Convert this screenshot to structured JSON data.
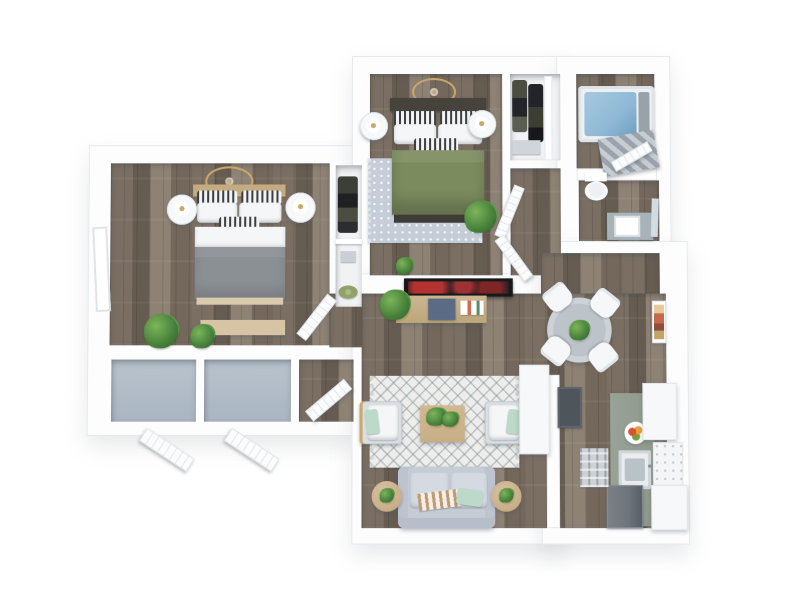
{
  "meta": {
    "title": "3D rendered floor plan — two bedroom apartment",
    "view": "top-down 3D render",
    "visible_text": "none"
  },
  "palette": {
    "background": "#ffffff",
    "wall": "#fdfdfd",
    "wall_edge": "#e7eaee",
    "wood": "#7b6f63",
    "wood_dark": "#675c51",
    "wood_light": "#8e8274",
    "closet_floor": "#a9b5c1",
    "rug_living": "#edeeec",
    "rug_bedroom": "#c5ced8",
    "bed_gray": "#8b9095",
    "bed_green": "#7c8b5e",
    "headboard_dark": "#46423c",
    "headboard_tan": "#c4ab80",
    "pillow_white": "#f4f6f7",
    "mint": "#bcd9c9",
    "tub_water": "#8fb9d6",
    "curtain_gray": "#9aa3ab",
    "counter_sage": "#8e988c",
    "cabinet_white": "#f7f8f9",
    "fridge_gray": "#6d747b",
    "stove_gray": "#4e555b",
    "tv_black": "#17181a",
    "tv_red": "#b43434",
    "table_gray": "#bcc3c9",
    "side_table_tan": "#c8ae87",
    "plant_green": "#46803a",
    "plant_dark": "#2f5e28",
    "gold": "#c9a96a",
    "bench_tan": "#d7c4a4",
    "blue_box": "#5a6b86",
    "art_accent": "#c46a4a"
  },
  "scene": {
    "rooms": [
      {
        "name": "bedroom-1",
        "position": "left",
        "items": [
          "ceiling-fan-gold",
          "bed-gray-queen",
          "nightstand-left",
          "nightstand-right",
          "table-lamps",
          "foot-bench",
          "potted-plants",
          "window",
          "reach-in-closet"
        ]
      },
      {
        "name": "bedroom-2",
        "position": "top-center",
        "items": [
          "ceiling-medallion-gold",
          "bed-green-queen",
          "nightstand-left",
          "nightstand-right",
          "patterned-area-rug",
          "potted-plant",
          "walk-in-closet-with-clothes"
        ]
      },
      {
        "name": "bathroom",
        "position": "top-right",
        "items": [
          "bathtub-with-water",
          "shower-curtain",
          "toilet",
          "vanity-with-sink",
          "mirror"
        ]
      },
      {
        "name": "hallway-vestibule",
        "position": "center",
        "items": [
          "open-door",
          "open-door"
        ]
      },
      {
        "name": "dining-area",
        "position": "right-center",
        "items": [
          "round-table",
          "dining-chair-1",
          "dining-chair-2",
          "dining-chair-3",
          "dining-chair-4",
          "centerpiece-plant",
          "wall-art"
        ]
      },
      {
        "name": "living-room",
        "position": "bottom-center",
        "items": [
          "tv",
          "media-console",
          "monstera-plant",
          "storage-box",
          "books",
          "diamond-pattern-rug",
          "coffee-table-with-plant",
          "armchair-left",
          "armchair-right",
          "sofa",
          "side-table-left",
          "side-table-right"
        ]
      },
      {
        "name": "kitchen",
        "position": "bottom-right",
        "items": [
          "peninsula-counter",
          "stove",
          "sink-counter-run",
          "upper-cabinets",
          "lower-cabinets",
          "tile-backsplash",
          "refrigerator",
          "fruit-bowl",
          "floor-mat"
        ]
      },
      {
        "name": "storage-closets",
        "position": "bottom-left",
        "items": [
          "closet-cell-1",
          "closet-cell-2",
          "closet-cell-3",
          "louvered-door-1",
          "louvered-door-2",
          "hinged-door"
        ]
      }
    ]
  }
}
